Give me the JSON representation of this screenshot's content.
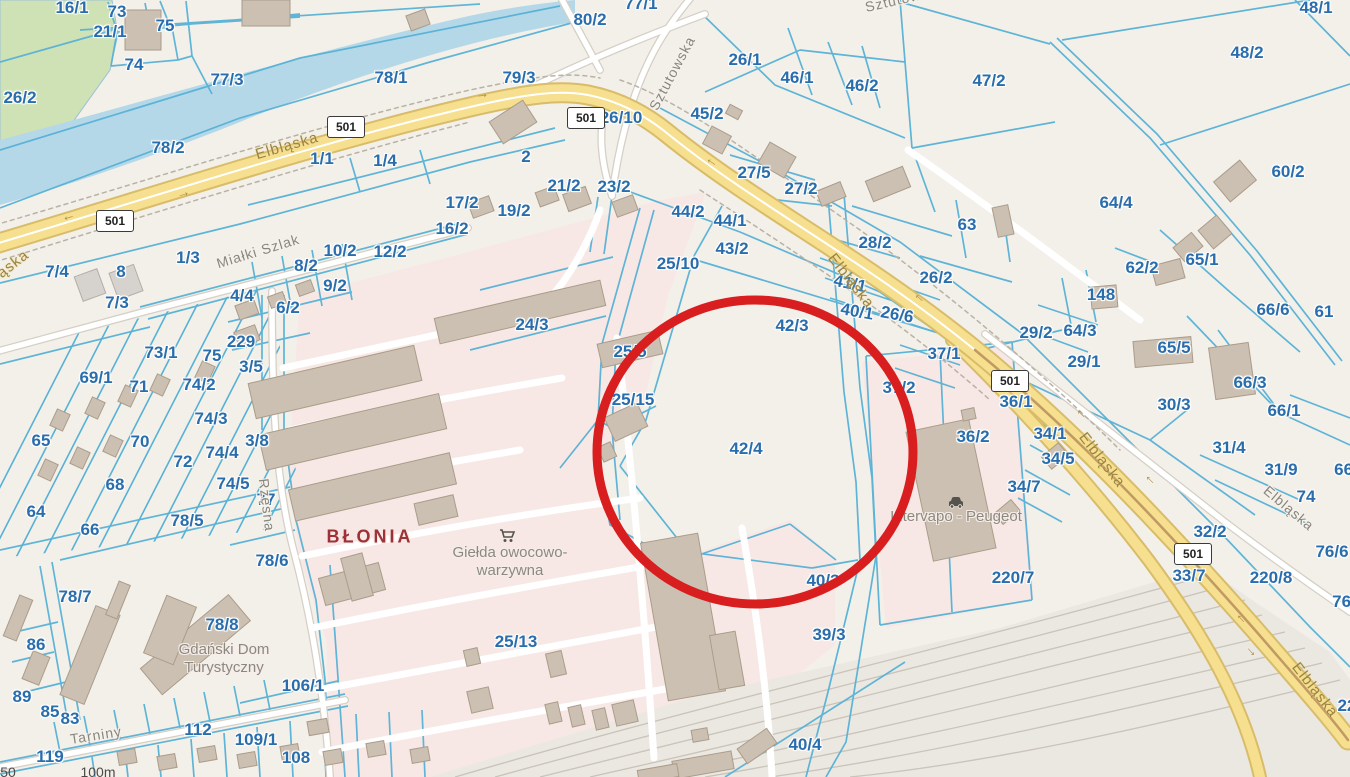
{
  "map": {
    "type": "cadastral-parcel-map",
    "highlighted_parcel": "42/4",
    "parcel_labels": [
      [
        "16/1",
        72,
        8
      ],
      [
        "73",
        117,
        12
      ],
      [
        "21/1",
        110,
        32
      ],
      [
        "75",
        165,
        26
      ],
      [
        "74",
        134,
        65
      ],
      [
        "26/2",
        20,
        98
      ],
      [
        "77/3",
        227,
        80
      ],
      [
        "78/1",
        391,
        78
      ],
      [
        "79/3",
        519,
        78
      ],
      [
        "80/2",
        590,
        20
      ],
      [
        "77/1",
        641,
        4
      ],
      [
        "78/2",
        168,
        148
      ],
      [
        "1/1",
        322,
        159
      ],
      [
        "1/4",
        385,
        161
      ],
      [
        "1/3",
        188,
        258
      ],
      [
        "2",
        526,
        157
      ],
      [
        "26/10",
        621,
        118
      ],
      [
        "26/1",
        745,
        60
      ],
      [
        "46/1",
        797,
        78
      ],
      [
        "46/2",
        862,
        86
      ],
      [
        "45/2",
        707,
        114
      ],
      [
        "27/5",
        754,
        173
      ],
      [
        "27/2",
        801,
        189
      ],
      [
        "44/2",
        688,
        212
      ],
      [
        "44/1",
        730,
        221
      ],
      [
        "43/2",
        732,
        249
      ],
      [
        "25/10",
        678,
        264
      ],
      [
        "28/2",
        875,
        243
      ],
      [
        "63",
        967,
        225
      ],
      [
        "26/2",
        936,
        278
      ],
      [
        "41/1",
        850,
        284,
        12
      ],
      [
        "40/1",
        857,
        312,
        10
      ],
      [
        "26/6",
        897,
        315,
        10
      ],
      [
        "42/3",
        792,
        326
      ],
      [
        "37/1",
        944,
        354
      ],
      [
        "37/2",
        899,
        388
      ],
      [
        "36/1",
        1016,
        402
      ],
      [
        "36/2",
        973,
        437
      ],
      [
        "34/1",
        1050,
        434
      ],
      [
        "34/5",
        1058,
        459
      ],
      [
        "34/7",
        1024,
        487
      ],
      [
        "42/4",
        746,
        449
      ],
      [
        "47/2",
        989,
        81
      ],
      [
        "48/1",
        1316,
        8
      ],
      [
        "48/2",
        1247,
        53
      ],
      [
        "60/2",
        1288,
        172
      ],
      [
        "64/4",
        1116,
        203
      ],
      [
        "65/1",
        1202,
        260
      ],
      [
        "62/2",
        1142,
        268
      ],
      [
        "148",
        1101,
        295
      ],
      [
        "66/6",
        1273,
        310
      ],
      [
        "61",
        1324,
        312
      ],
      [
        "29/2",
        1036,
        333
      ],
      [
        "64/3",
        1080,
        331
      ],
      [
        "29/1",
        1084,
        362
      ],
      [
        "65/5",
        1174,
        348
      ],
      [
        "66/3",
        1250,
        383
      ],
      [
        "30/3",
        1174,
        405
      ],
      [
        "66/1",
        1284,
        411
      ],
      [
        "31/4",
        1229,
        448
      ],
      [
        "31/9",
        1281,
        470
      ],
      [
        "74",
        1306,
        497
      ],
      [
        "66/",
        1346,
        470
      ],
      [
        "76/6",
        1332,
        552
      ],
      [
        "76/",
        1344,
        602
      ],
      [
        "32/2",
        1210,
        532
      ],
      [
        "33/7",
        1189,
        576
      ],
      [
        "220/8",
        1271,
        578
      ],
      [
        "220/7",
        1013,
        578
      ],
      [
        "22",
        1347,
        706
      ],
      [
        "40/3",
        823,
        581
      ],
      [
        "39/3",
        829,
        635
      ],
      [
        "40/4",
        805,
        745
      ],
      [
        "25/13",
        516,
        642
      ],
      [
        "7/4",
        57,
        272
      ],
      [
        "8",
        121,
        272
      ],
      [
        "7/3",
        117,
        303
      ],
      [
        "8/2",
        306,
        266
      ],
      [
        "9/2",
        335,
        286
      ],
      [
        "4/4",
        242,
        296
      ],
      [
        "6/2",
        288,
        308
      ],
      [
        "229",
        241,
        342
      ],
      [
        "3/5",
        251,
        367
      ],
      [
        "73/1",
        161,
        353
      ],
      [
        "75",
        212,
        356
      ],
      [
        "74/2",
        199,
        385
      ],
      [
        "69/1",
        96,
        378
      ],
      [
        "71",
        139,
        387
      ],
      [
        "74/3",
        211,
        419
      ],
      [
        "65",
        41,
        441
      ],
      [
        "70",
        140,
        442
      ],
      [
        "72",
        183,
        462
      ],
      [
        "3/8",
        257,
        441
      ],
      [
        "74/4",
        222,
        453
      ],
      [
        "68",
        115,
        485
      ],
      [
        "74/5",
        233,
        484
      ],
      [
        "64",
        36,
        512
      ],
      [
        "77",
        266,
        500
      ],
      [
        "78/5",
        187,
        521
      ],
      [
        "66",
        90,
        530
      ],
      [
        "78/6",
        272,
        561
      ],
      [
        "78/7",
        75,
        597
      ],
      [
        "78/8",
        222,
        625
      ],
      [
        "86",
        36,
        645
      ],
      [
        "89",
        22,
        697
      ],
      [
        "85",
        50,
        712
      ],
      [
        "83",
        70,
        719
      ],
      [
        "106/1",
        303,
        686
      ],
      [
        "119",
        50,
        757
      ],
      [
        "112",
        198,
        730
      ],
      [
        "109/1",
        256,
        740
      ],
      [
        "108",
        296,
        758
      ],
      [
        "25/5",
        630,
        352
      ],
      [
        "25/15",
        633,
        400
      ],
      [
        "24/3",
        532,
        325
      ],
      [
        "16/2",
        452,
        229
      ],
      [
        "17/2",
        462,
        203
      ],
      [
        "19/2",
        514,
        211
      ],
      [
        "21/2",
        564,
        186
      ],
      [
        "23/2",
        614,
        187
      ],
      [
        "10/2",
        340,
        251
      ],
      [
        "12/2",
        390,
        252
      ]
    ],
    "street_labels": [
      {
        "t": "Elbląska",
        "x": 287,
        "y": 146,
        "r": -16,
        "k": "roadname"
      },
      {
        "t": "Elbląska",
        "x": 851,
        "y": 281,
        "r": 52,
        "k": "roadname"
      },
      {
        "t": "Elbląska",
        "x": 1102,
        "y": 460,
        "r": 52,
        "k": "roadname"
      },
      {
        "t": "Elbląska",
        "x": 1315,
        "y": 690,
        "r": 52,
        "k": "roadname"
      },
      {
        "t": "ąska",
        "x": 13,
        "y": 264,
        "r": -38,
        "k": "roadname"
      },
      {
        "t": "Elbląska",
        "x": 1289,
        "y": 508,
        "r": 40,
        "k": "street"
      },
      {
        "t": "Miałki Szlak",
        "x": 258,
        "y": 251,
        "r": -17,
        "k": "street"
      },
      {
        "t": "Sztutowska",
        "x": 672,
        "y": 73,
        "r": -62,
        "k": "street"
      },
      {
        "t": "Sztutowska",
        "x": 905,
        "y": -2,
        "r": -13,
        "k": "street"
      },
      {
        "t": "Rzęsna",
        "x": 267,
        "y": 505,
        "r": 83,
        "k": "street"
      },
      {
        "t": "Tarniny",
        "x": 96,
        "y": 735,
        "r": -9,
        "k": "street"
      }
    ],
    "poi_labels": [
      {
        "t": "BŁONIA",
        "x": 370,
        "y": 537,
        "k": "blonia"
      },
      {
        "t": "Giełda owocowo-\nwarzywna",
        "x": 510,
        "y": 562,
        "k": "poi"
      },
      {
        "t": "Gdański Dom\nTurystyczny",
        "x": 224,
        "y": 659,
        "k": "poi"
      },
      {
        "t": "Intervapo - Peugeot",
        "x": 956,
        "y": 517,
        "k": "poi"
      }
    ],
    "route_shields": [
      {
        "text": "501",
        "x": 114,
        "y": 220
      },
      {
        "text": "501",
        "x": 345,
        "y": 126
      },
      {
        "text": "501",
        "x": 585,
        "y": 117
      },
      {
        "text": "501",
        "x": 1009,
        "y": 380
      },
      {
        "text": "501",
        "x": 1192,
        "y": 553
      }
    ],
    "road_arrows": [
      {
        "g": "←",
        "x": 68,
        "y": 215,
        "r": -16
      },
      {
        "g": "→",
        "x": 183,
        "y": 192,
        "r": -16
      },
      {
        "g": "→",
        "x": 482,
        "y": 93,
        "r": -6
      },
      {
        "g": "←",
        "x": 713,
        "y": 160,
        "r": 33
      },
      {
        "g": "←",
        "x": 921,
        "y": 296,
        "r": 40
      },
      {
        "g": "←",
        "x": 1083,
        "y": 412,
        "r": 45
      },
      {
        "g": "←",
        "x": 1152,
        "y": 478,
        "r": 45
      },
      {
        "g": "←",
        "x": 1243,
        "y": 617,
        "r": 48
      },
      {
        "g": "→",
        "x": 1253,
        "y": 650,
        "r": 48
      }
    ],
    "scale_labels": [
      {
        "t": "50",
        "x": 8,
        "y": 772
      },
      {
        "t": "100m",
        "x": 98,
        "y": 772
      }
    ],
    "icons": [
      {
        "name": "shopping-cart-icon",
        "x": 508,
        "y": 536
      },
      {
        "name": "car-icon",
        "x": 956,
        "y": 503
      }
    ]
  },
  "annotation": {
    "shape": "ellipse",
    "cx": 755,
    "cy": 452,
    "rx": 158,
    "ry": 152,
    "color": "#d81e1e",
    "stroke_width": 9
  },
  "colors": {
    "background": "#f3f0ea",
    "parcel_line": "#57b1d6",
    "parcel_label": "#2a6dad",
    "water": "#b5d8e8",
    "green_area": "#cfe2b5",
    "industrial_pink": "#f7e8e5",
    "rail_area": "#ebe8e2",
    "road_yellow": "#f6df8e",
    "road_casing": "#d8bc69",
    "building": "#ccc0b2",
    "highlight_red": "#d81e1e"
  }
}
